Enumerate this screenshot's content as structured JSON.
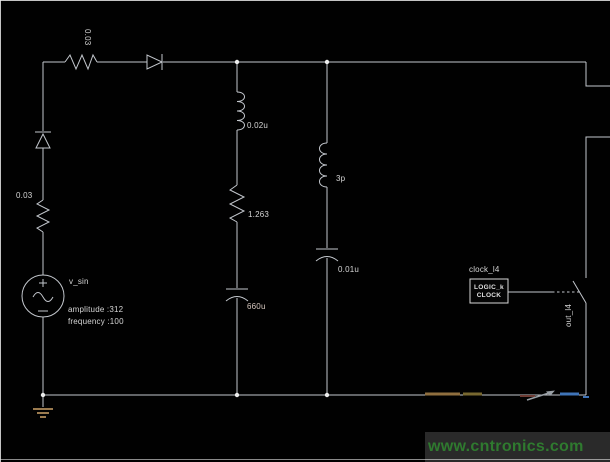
{
  "schematic": {
    "source": {
      "name": "v_sin",
      "amplitude": "amplitude :312",
      "frequency": "frequency :100"
    },
    "components": {
      "top_resistor": "0.03",
      "left_resistor": "0.03",
      "mid_inductor": "0.02u",
      "mid_resistor": "1.263",
      "mid_capacitor": "660u",
      "right_inductor": "3p",
      "right_capacitor": "0.01u"
    },
    "clock": {
      "title": "clock_l4",
      "line1": "LOGIC_k",
      "line2": "CLOCK"
    },
    "switch_label": "out_l4",
    "colors": {
      "wire": "#c3c7cd",
      "ground": "#9b7b4f",
      "junction": "#ececec",
      "highlight_orange": "#8f6e3e",
      "highlight_olive": "#77672f",
      "highlight_red": "#6e3c34",
      "highlight_blue": "#3f74b8",
      "probe_arrow": "#9aa0a6"
    }
  },
  "watermark": {
    "text": "www.cntronics.com",
    "color": "#2f7a2f",
    "background": "#2a2a2a"
  }
}
